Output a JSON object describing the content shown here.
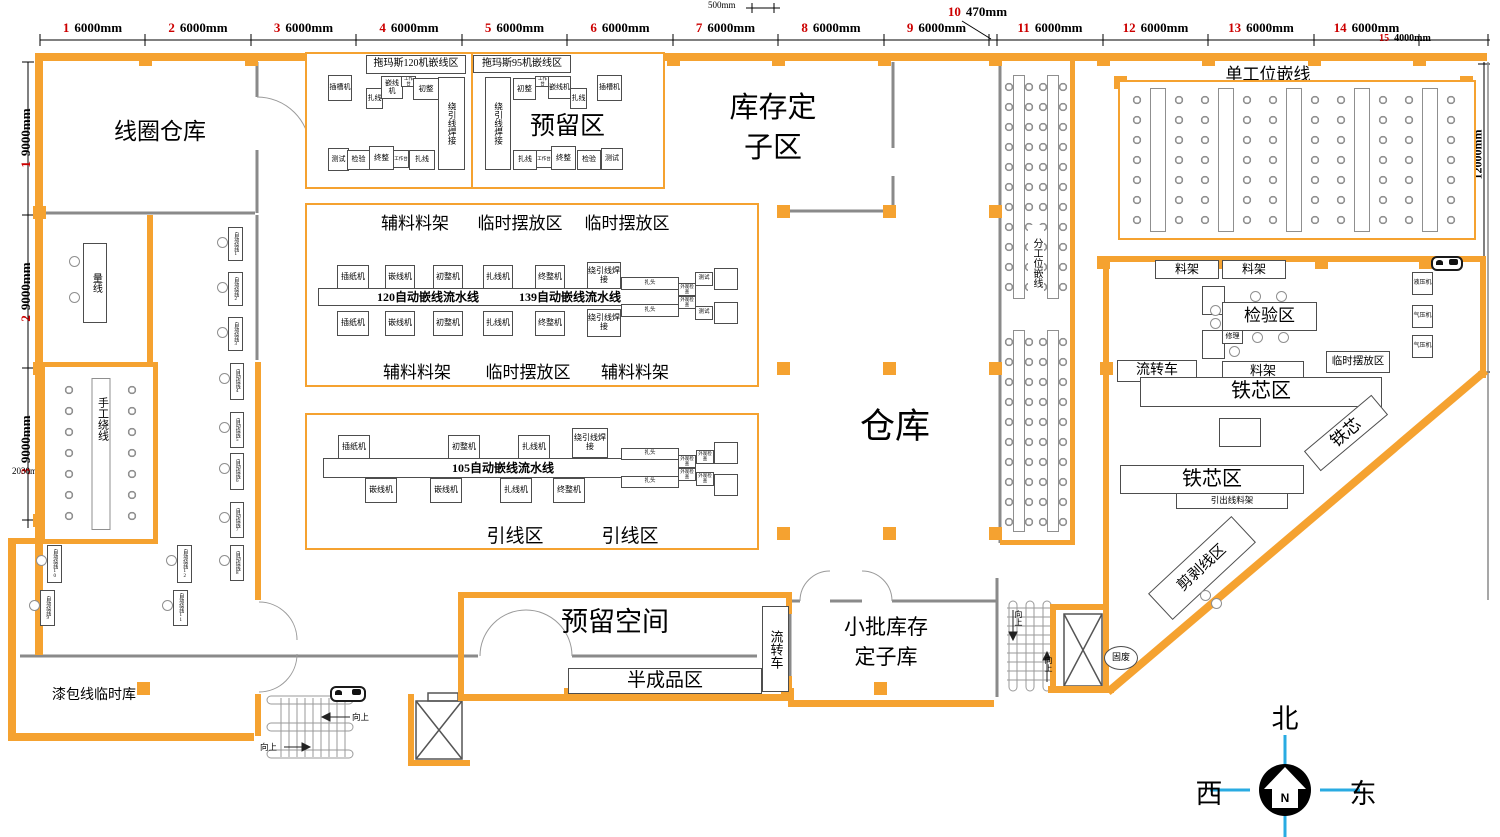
{
  "colors": {
    "wall_orange": "#F5A230",
    "grid_red": "#CC0000",
    "compass_blue": "#29ABE2",
    "line_gray": "#8A8A8A"
  },
  "top_ruler": {
    "mini_dim": "500mm",
    "bays": [
      {
        "no": "1",
        "len": "6000mm"
      },
      {
        "no": "2",
        "len": "6000mm"
      },
      {
        "no": "3",
        "len": "6000mm"
      },
      {
        "no": "4",
        "len": "6000mm"
      },
      {
        "no": "5",
        "len": "6000mm"
      },
      {
        "no": "6",
        "len": "6000mm"
      },
      {
        "no": "7",
        "len": "6000mm"
      },
      {
        "no": "8",
        "len": "6000mm"
      },
      {
        "no": "9",
        "len": "6000mm"
      }
    ],
    "bay10": {
      "no": "10",
      "len": "470mm"
    },
    "bays_right": [
      {
        "no": "11",
        "len": "6000mm"
      },
      {
        "no": "12",
        "len": "6000mm"
      },
      {
        "no": "13",
        "len": "6000mm"
      },
      {
        "no": "14",
        "len": "6000mm"
      }
    ],
    "bay15": {
      "no": "15",
      "len": "4000mm"
    }
  },
  "left_ruler": {
    "rows": [
      {
        "no": "1",
        "len": "9000mm"
      },
      {
        "no": "2",
        "len": "9000mm"
      },
      {
        "no": "3",
        "len": "9000mm"
      }
    ],
    "mini_dim": "2030mm"
  },
  "right_ruler": {
    "len": "12000mm"
  },
  "rooms": {
    "coil_warehouse": "线圈仓库",
    "stock_stator_zone": "库存定子区",
    "warehouse": "仓库",
    "reserved_space": "预留空间",
    "semi_finished_area": "半成品区",
    "small_batch_stator": "小批库存定子库",
    "enamel_wire_temp": "漆包线临时库",
    "transfer_cart": "流转车"
  },
  "winding": {
    "measure_wire": "量线",
    "manual_winding": "手工绕线",
    "auto_winders": [
      "自动绕线1",
      "自动绕线2",
      "自动绕线3",
      "自动绕线4",
      "自动绕线5",
      "自动绕线6",
      "自动绕线7",
      "自动绕线8",
      "自动绕线9",
      "自动绕线10",
      "自动绕线11",
      "自动绕线12"
    ]
  },
  "tuomasi120": {
    "title": "拖玛斯120机嵌线区",
    "slot": "插槽机",
    "tie_top": "扎线",
    "insert": "嵌线机",
    "bench_top": "工作台",
    "pre": "初整",
    "weld": "绕引线焊接",
    "test": "测试",
    "check": "检验",
    "final": "终整",
    "bench_bot": "工作台",
    "tie_bot": "扎线"
  },
  "tuomasi95": {
    "title": "拖玛斯95机嵌线区",
    "weld": "绕引线焊接",
    "pre": "初整",
    "bench_top": "工作台",
    "insert": "嵌线机",
    "tie_top": "扎线",
    "slot": "插槽机",
    "reserved": "预留区",
    "tie_bot": "扎线",
    "bench_bot": "工作台",
    "final": "终整",
    "check": "检验",
    "test": "测试"
  },
  "line_block": {
    "strip_top": [
      "辅料料架",
      "临时摆放区",
      "临时摆放区"
    ],
    "machines_top": [
      "插纸机",
      "嵌线机",
      "初整机",
      "扎线机",
      "终整机"
    ],
    "weld_top": "绕引线焊接",
    "belt_left": "120自动嵌线流水线",
    "belt_right": "139自动嵌线流水线",
    "machines_bottom": [
      "插纸机",
      "嵌线机",
      "初整机",
      "扎线机",
      "终整机"
    ],
    "weld_bottom": "绕引线焊接",
    "clamp": "扎头",
    "visual": "外观检查",
    "test": "测试",
    "strip_bottom": [
      "辅料料架",
      "临时摆放区",
      "辅料料架"
    ]
  },
  "line105": {
    "machines_top": [
      "插纸机",
      "初整机",
      "扎线机"
    ],
    "weld": "绕引线焊接",
    "belt": "105自动嵌线流水线",
    "machines_bottom": [
      "嵌线机",
      "嵌线机",
      "扎线机",
      "终整机"
    ],
    "clamp": "扎头",
    "visual": "外观检查",
    "strip_bottom": [
      "引线区",
      "引线区"
    ]
  },
  "station_areas": {
    "single": "单工位嵌线",
    "split": "分工位嵌线"
  },
  "right_area": {
    "racks_top": [
      "料架",
      "料架"
    ],
    "hydraulic": "液压机",
    "pneumatic1": "气压机",
    "pneumatic2": "气压机",
    "inspection": "检验区",
    "repair": "修理",
    "transfer_cart": "流转车",
    "rack_mid": "料架",
    "temp_area": "临时摆放区",
    "core_area1": "铁芯区",
    "core_label": "铁芯",
    "core_area2": "铁芯区",
    "outgoing_rack": "引出线料架",
    "cut_strip": "剪剥线区",
    "solid_waste": "固废"
  },
  "stairs": {
    "up": "向上"
  },
  "compass": {
    "north": "北",
    "west": "西",
    "east": "东",
    "letter": "N"
  }
}
